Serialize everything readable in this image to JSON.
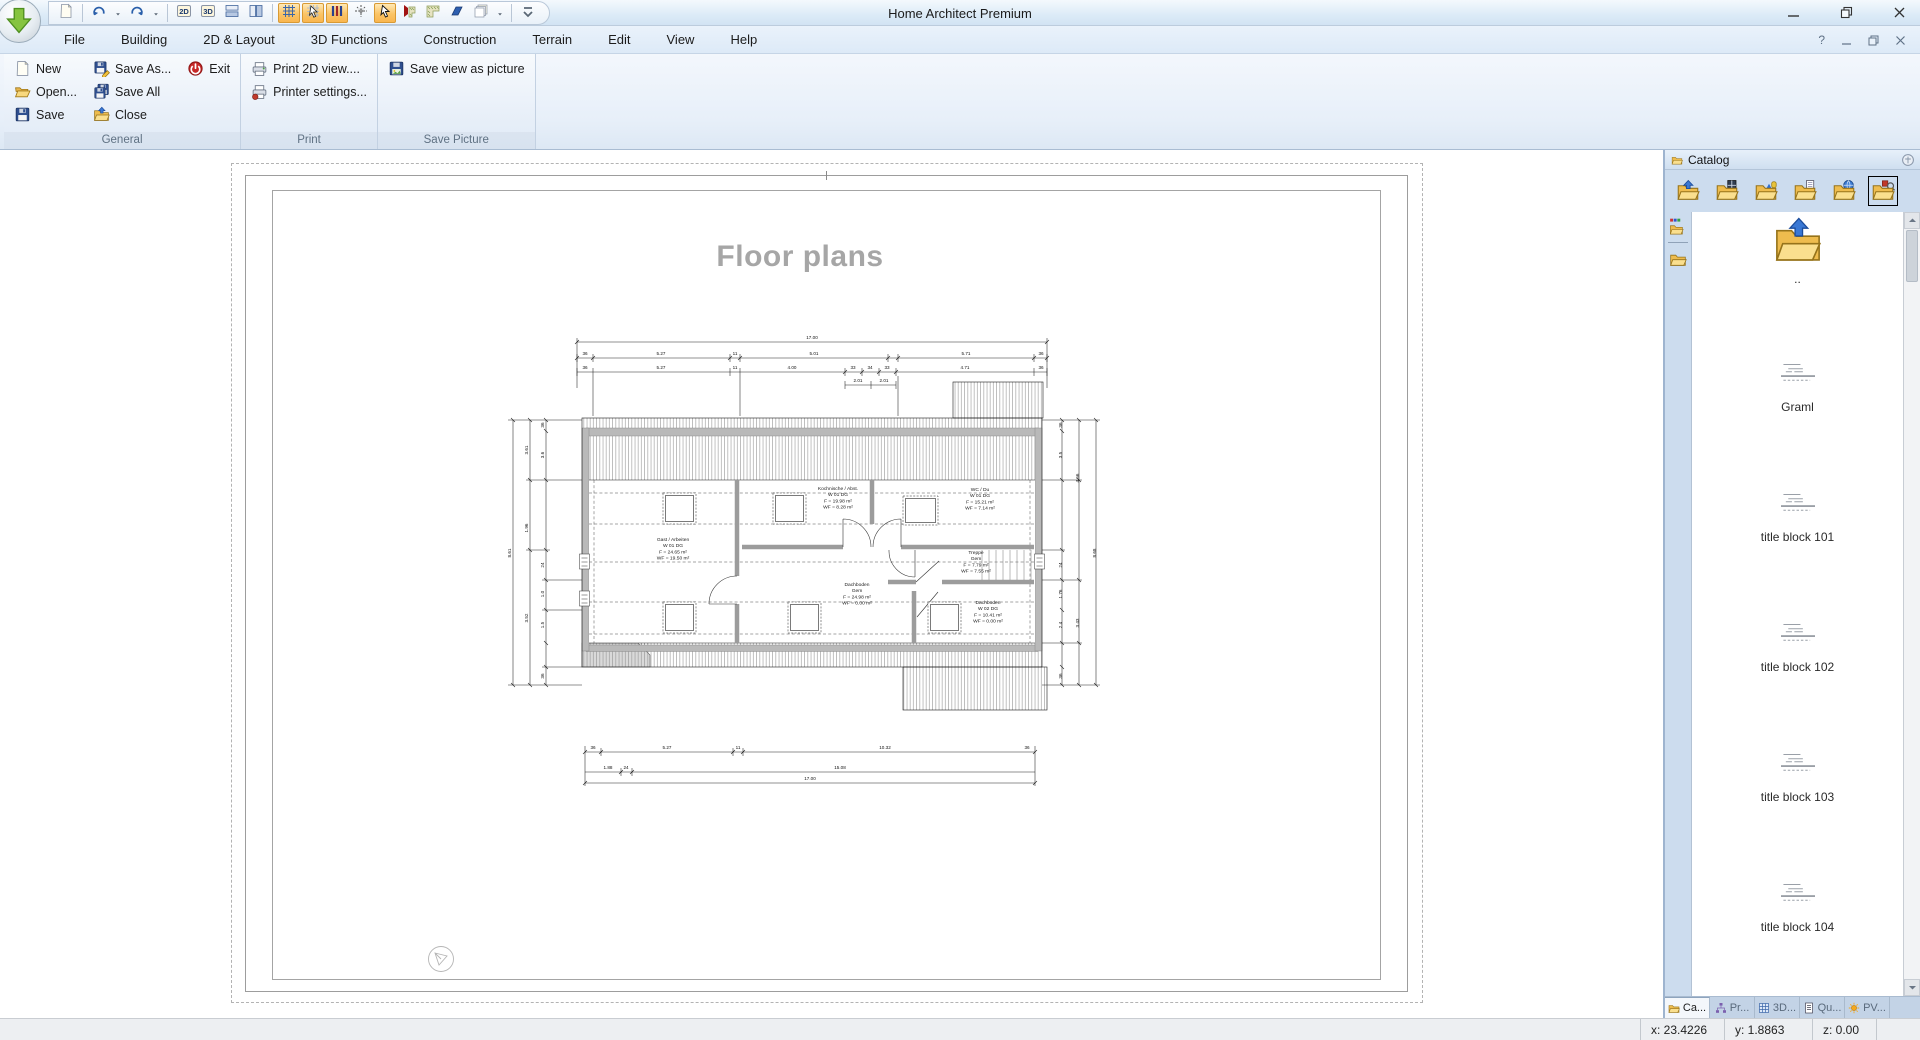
{
  "window": {
    "title": "Home Architect Premium"
  },
  "quick_access": {
    "items": [
      {
        "name": "new-drawing-button",
        "icon": "page-small"
      },
      {
        "sep": true
      },
      {
        "name": "undo-button",
        "icon": "undo"
      },
      {
        "name": "undo-menu-button",
        "icon": "caret"
      },
      {
        "name": "redo-button",
        "icon": "redo"
      },
      {
        "name": "redo-menu-button",
        "icon": "caret"
      },
      {
        "sep": true
      },
      {
        "name": "view-2d-button",
        "icon": "b2d"
      },
      {
        "name": "view-3d-button",
        "icon": "b3d"
      },
      {
        "name": "split-horizontal-button",
        "icon": "split-h"
      },
      {
        "name": "split-vertical-button",
        "icon": "split-v"
      },
      {
        "sep": true
      },
      {
        "name": "grid-toggle-button",
        "icon": "grid",
        "selected": true
      },
      {
        "name": "snap-select-button",
        "icon": "pointer-grid",
        "selected": true
      },
      {
        "name": "guides-toggle-button",
        "icon": "columns",
        "selected": true
      },
      {
        "name": "crosshair-button",
        "icon": "crosshair"
      },
      {
        "name": "pointer-button",
        "icon": "pointer",
        "selected": true
      },
      {
        "name": "roof-corner-red-button",
        "icon": "corner-red"
      },
      {
        "name": "roof-corner-green-button",
        "icon": "corner-green"
      },
      {
        "name": "roof-plane-button",
        "icon": "para-blue"
      },
      {
        "name": "layers-button",
        "icon": "layers"
      },
      {
        "name": "layers-menu-button",
        "icon": "caret"
      },
      {
        "sep": true
      },
      {
        "name": "toolbar-overflow-button",
        "icon": "chevmore"
      }
    ]
  },
  "menus": [
    {
      "label": "File",
      "name": "menu-file"
    },
    {
      "label": "Building",
      "name": "menu-building"
    },
    {
      "label": "2D & Layout",
      "name": "menu-2d-layout"
    },
    {
      "label": "3D Functions",
      "name": "menu-3d-functions"
    },
    {
      "label": "Construction",
      "name": "menu-construction"
    },
    {
      "label": "Terrain",
      "name": "menu-terrain"
    },
    {
      "label": "Edit",
      "name": "menu-edit"
    },
    {
      "label": "View",
      "name": "menu-view"
    },
    {
      "label": "Help",
      "name": "menu-help"
    }
  ],
  "ribbon": {
    "groups": [
      {
        "label": "General",
        "columns": [
          [
            {
              "label": "New",
              "icon": "page-new",
              "name": "new-button"
            },
            {
              "label": "Open...",
              "icon": "folder-open",
              "name": "open-button"
            },
            {
              "label": "Save",
              "icon": "floppy",
              "name": "save-button"
            }
          ],
          [
            {
              "label": "Save As...",
              "icon": "floppy-pencil",
              "name": "save-as-button"
            },
            {
              "label": "Save All",
              "icon": "floppy-all",
              "name": "save-all-button"
            },
            {
              "label": "Close",
              "icon": "folder-close",
              "name": "close-button"
            }
          ],
          [
            {
              "label": "Exit",
              "icon": "power",
              "name": "exit-button"
            }
          ]
        ]
      },
      {
        "label": "Print",
        "columns": [
          [
            {
              "label": "Print 2D view....",
              "icon": "printer",
              "name": "print-2d-view-button"
            },
            {
              "label": "Printer settings...",
              "icon": "printer-settings",
              "name": "printer-settings-button"
            }
          ]
        ]
      },
      {
        "label": "Save Picture",
        "columns": [
          [
            {
              "label": "Save view as picture",
              "icon": "floppy-picture",
              "name": "save-view-as-picture-button"
            }
          ]
        ]
      }
    ]
  },
  "page": {
    "title": "Floor plans"
  },
  "plan": {
    "rooms": [
      {
        "name": "room-gast",
        "x": 183,
        "y": 213,
        "lines": [
          "Gast / Arbeiten",
          "W 01 DG",
          "F = 24.65 m²",
          "WF = 19.50 m²"
        ]
      },
      {
        "name": "room-kochnische",
        "x": 348,
        "y": 162,
        "lines": [
          "Kochnische / Abst.",
          "W 01 DG",
          "F = 19.98 m²",
          "WF = 8.28 m²"
        ]
      },
      {
        "name": "room-wc",
        "x": 490,
        "y": 163,
        "lines": [
          "WC / Du",
          "W 01 DG",
          "F = 15.21 m²",
          "WF = 7.14 m²"
        ]
      },
      {
        "name": "room-treppe",
        "x": 486,
        "y": 226,
        "lines": [
          "Treppe",
          "Gem",
          "F = 7.79 m²",
          "WF = 7.55 m²"
        ]
      },
      {
        "name": "room-dachboden-gem",
        "x": 367,
        "y": 258,
        "lines": [
          "Dachboden",
          "Gem",
          "F = 24.98 m²",
          "WF = 0.00 m²"
        ]
      },
      {
        "name": "room-dachboden-w02",
        "x": 498,
        "y": 276,
        "lines": [
          "Dachboden",
          "W 02 DG",
          "F = 10.41 m²",
          "WF = 0.00 m²"
        ]
      }
    ],
    "dims": [
      {
        "t": "17.00",
        "x": 322,
        "y": 11
      },
      {
        "t": "36",
        "x": 95,
        "y": 27
      },
      {
        "t": "5.27",
        "x": 171,
        "y": 27
      },
      {
        "t": "11",
        "x": 245,
        "y": 27
      },
      {
        "t": "5.01",
        "x": 324,
        "y": 27
      },
      {
        "t": "5.71",
        "x": 476,
        "y": 27
      },
      {
        "t": "36",
        "x": 551,
        "y": 27
      },
      {
        "t": "36",
        "x": 95,
        "y": 41
      },
      {
        "t": "5.27",
        "x": 171,
        "y": 41
      },
      {
        "t": "11",
        "x": 245,
        "y": 41
      },
      {
        "t": "4.00",
        "x": 302,
        "y": 41
      },
      {
        "t": "33",
        "x": 363,
        "y": 41
      },
      {
        "t": "34",
        "x": 380,
        "y": 41
      },
      {
        "t": "33",
        "x": 397,
        "y": 41
      },
      {
        "t": "4.71",
        "x": 475,
        "y": 41
      },
      {
        "t": "36",
        "x": 551,
        "y": 41
      },
      {
        "t": "2.01",
        "x": 368,
        "y": 54
      },
      {
        "t": "2.01",
        "x": 394,
        "y": 54
      },
      {
        "t": "36",
        "x": 103,
        "y": 421
      },
      {
        "t": "5.27",
        "x": 177,
        "y": 421
      },
      {
        "t": "11",
        "x": 248,
        "y": 421
      },
      {
        "t": "10.32",
        "x": 395,
        "y": 421
      },
      {
        "t": "36",
        "x": 537,
        "y": 421
      },
      {
        "t": "1.88",
        "x": 118,
        "y": 441
      },
      {
        "t": "24",
        "x": 136,
        "y": 441
      },
      {
        "t": "15.08",
        "x": 350,
        "y": 441
      },
      {
        "t": "17.00",
        "x": 320,
        "y": 452
      },
      {
        "t": "8.61",
        "x": 21,
        "y": 225,
        "r": -90
      },
      {
        "t": "3.61",
        "x": 38,
        "y": 122,
        "r": -90
      },
      {
        "t": "1.96",
        "x": 38,
        "y": 200,
        "r": -90
      },
      {
        "t": "3.52",
        "x": 38,
        "y": 290,
        "r": -90
      },
      {
        "t": "36",
        "x": 54,
        "y": 97,
        "r": -90
      },
      {
        "t": "3.6",
        "x": 54,
        "y": 127,
        "r": -90
      },
      {
        "t": "24",
        "x": 54,
        "y": 237,
        "r": -90
      },
      {
        "t": "1.0",
        "x": 54,
        "y": 266,
        "r": -90
      },
      {
        "t": "1.5",
        "x": 54,
        "y": 297,
        "r": -90
      },
      {
        "t": "36",
        "x": 54,
        "y": 348,
        "r": -90
      },
      {
        "t": "36",
        "x": 572,
        "y": 97,
        "r": -90
      },
      {
        "t": "3.5",
        "x": 572,
        "y": 127,
        "r": -90
      },
      {
        "t": "24",
        "x": 572,
        "y": 237,
        "r": -90
      },
      {
        "t": "1.76",
        "x": 572,
        "y": 266,
        "r": -90
      },
      {
        "t": "2.4",
        "x": 572,
        "y": 297,
        "r": -90
      },
      {
        "t": "36",
        "x": 572,
        "y": 348,
        "r": -90
      },
      {
        "t": "4.56",
        "x": 589,
        "y": 150,
        "r": -90
      },
      {
        "t": "3.43",
        "x": 589,
        "y": 295,
        "r": -90
      },
      {
        "t": "8.68",
        "x": 606,
        "y": 225,
        "r": -90
      }
    ]
  },
  "catalog": {
    "title": "Catalog",
    "toolbar": [
      {
        "name": "catalog-up-button",
        "icon": "cat-up"
      },
      {
        "name": "catalog-windows-button",
        "icon": "cat-window"
      },
      {
        "name": "catalog-objects-button",
        "icon": "cat-3d"
      },
      {
        "name": "catalog-templates-button",
        "icon": "cat-doc"
      },
      {
        "name": "catalog-web-button",
        "icon": "cat-globe"
      },
      {
        "name": "catalog-search-button",
        "icon": "cat-search",
        "selected": true
      }
    ],
    "rail": [
      {
        "name": "rail-groups-button",
        "icon": "rail-colors"
      },
      {
        "name": "rail-folder-button",
        "icon": "rail-plain"
      }
    ],
    "items": [
      {
        "label": "..",
        "type": "up",
        "name": "catalog-item-parent"
      },
      {
        "label": "Graml",
        "type": "sketch",
        "name": "catalog-item-graml"
      },
      {
        "label": "title block 101",
        "type": "sketch",
        "name": "catalog-item-title-block-101"
      },
      {
        "label": "title block 102",
        "type": "sketch",
        "name": "catalog-item-title-block-102"
      },
      {
        "label": "title block 103",
        "type": "sketch",
        "name": "catalog-item-title-block-103"
      },
      {
        "label": "title block 104",
        "type": "sketch",
        "name": "catalog-item-title-block-104"
      }
    ],
    "tabs": [
      {
        "label": "Ca...",
        "icon": "tab-folder",
        "active": true,
        "name": "tab-catalog"
      },
      {
        "label": "Pr...",
        "icon": "tab-sitemap",
        "name": "tab-project"
      },
      {
        "label": "3D...",
        "icon": "tab-grid",
        "name": "tab-3d"
      },
      {
        "label": "Qu...",
        "icon": "tab-doc",
        "name": "tab-quantities"
      },
      {
        "label": "PV...",
        "icon": "tab-sun",
        "name": "tab-pv"
      }
    ]
  },
  "menubar_controls": {
    "help": "?"
  },
  "status": {
    "x_label": "x: 23.4226",
    "y_label": "y: 1.8863",
    "z_label": "z: 0.00"
  }
}
